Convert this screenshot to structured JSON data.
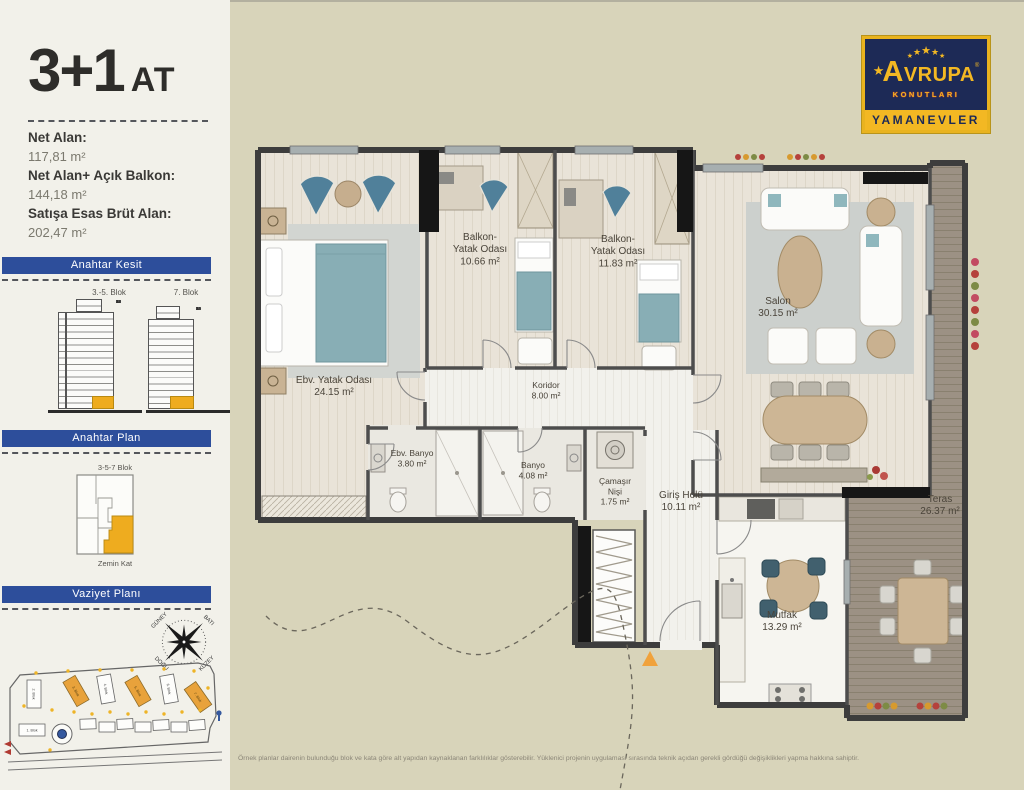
{
  "colors": {
    "accent_blue": "#2d4e9b",
    "accent_orange": "#eeac1f",
    "page_bg": "#d8d4ba",
    "sidebar_bg": "#f2f1ea",
    "logo_navy": "#1d2a56",
    "logo_yellow": "#f3b823"
  },
  "sidebar": {
    "title": "3+1",
    "title_suffix": "AT",
    "stats": [
      {
        "label": "Net Alan:",
        "value": "117,81 m²"
      },
      {
        "label": "Net Alan+ Açık Balkon:",
        "value": "144,18 m²"
      },
      {
        "label": "Satışa Esas Brüt Alan:",
        "value": "202,47 m²"
      }
    ],
    "sections": {
      "kesit": {
        "title": "Anahtar Kesit",
        "blocks": [
          {
            "name": "3.-5. Blok",
            "floors_top": 17
          },
          {
            "name": "7. Blok",
            "floors_top": 16
          }
        ]
      },
      "plan": {
        "title": "Anahtar Plan",
        "block_label": "3-5-7 Blok",
        "floor_label": "Zemin Kat"
      },
      "vaziyet": {
        "title": "Vaziyet Planı",
        "compass": {
          "nw": "GÜNEY",
          "ne": "BATI",
          "sw": "DOĞU",
          "se": "KUZEY"
        },
        "blocks": [
          "1. Blok",
          "2. Blok",
          "3. Blok",
          "4. Blok",
          "5. Blok",
          "6. Blok",
          "7. Blok"
        ]
      }
    }
  },
  "logo": {
    "star_icon": "★",
    "brand": "AVRUPA",
    "mark": "®",
    "sub": "KONUTLARI",
    "location": "YAMANEVLER"
  },
  "plan": {
    "rooms": [
      {
        "name": "Ebv. Yatak Odası",
        "area": "24.15 m²",
        "lines": [
          "Ebv. Yatak Odası",
          "24.15 m²"
        ]
      },
      {
        "name": "Balkon- Yatak Odası",
        "area": "10.66 m²",
        "lines": [
          "Balkon-",
          "Yatak Odası",
          "10.66 m²"
        ]
      },
      {
        "name": "Balkon- Yatak Odası",
        "area": "11.83 m²",
        "lines": [
          "Balkon-",
          "Yatak Odası",
          "11.83 m²"
        ]
      },
      {
        "name": "Salon",
        "area": "30.15 m²",
        "lines": [
          "Salon",
          "30.15 m²"
        ]
      },
      {
        "name": "Koridor",
        "area": "8.00 m²",
        "lines": [
          "Koridor",
          "8.00 m²"
        ]
      },
      {
        "name": "Ebv. Banyo",
        "area": "3.80 m²",
        "lines": [
          "Ebv. Banyo",
          "3.80 m²"
        ]
      },
      {
        "name": "Banyo",
        "area": "4.08 m²",
        "lines": [
          "Banyo",
          "4.08 m²"
        ]
      },
      {
        "name": "Çamaşır Nişi",
        "area": "1.75 m²",
        "lines": [
          "Çamaşır",
          "Nişi",
          "1.75 m²"
        ]
      },
      {
        "name": "Giriş Holü",
        "area": "10.11 m²",
        "lines": [
          "Giriş Holü",
          "10.11 m²"
        ]
      },
      {
        "name": "Mutfak",
        "area": "13.29 m²",
        "lines": [
          "Mutfak",
          "13.29 m²"
        ]
      },
      {
        "name": "Teras",
        "area": "26.37 m²",
        "lines": [
          "Teras",
          "26.37 m²"
        ]
      }
    ]
  },
  "footer": {
    "disclaimer": "Örnek planlar dairenin bulunduğu blok ve kata göre alt yapıdan kaynaklanan farklılıklar gösterebilir. Yüklenici projenin uygulaması sırasında teknik açıdan gerekli gördüğü değişiklikleri yapma hakkına sahiptir."
  }
}
